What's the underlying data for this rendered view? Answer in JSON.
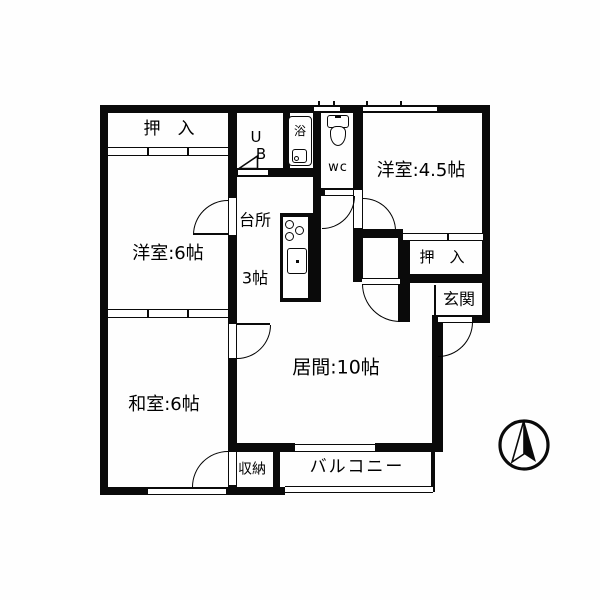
{
  "floorplan": {
    "labels": {
      "closet_top_left": "押　入",
      "western_room_6": "洋室:6帖",
      "japanese_room_6": "和室:6帖",
      "ub_line1": "U",
      "ub_line2": "B",
      "bath": "浴",
      "wc": "wc",
      "western_room_45": "洋室:4.5帖",
      "closet_right": "押　入",
      "entrance": "玄関",
      "kitchen_line1": "台所",
      "kitchen_line2": "3帖",
      "living_room": "居間:10帖",
      "storage": "収納",
      "balcony": "バルコニー"
    },
    "rooms": [
      {
        "name": "押入 (closet)",
        "location": "top-left"
      },
      {
        "name": "洋室",
        "size_tatami": "6帖",
        "location": "middle-left"
      },
      {
        "name": "和室",
        "size_tatami": "6帖",
        "location": "bottom-left"
      },
      {
        "name": "UB (unit bath)",
        "location": "top-center"
      },
      {
        "name": "浴 (bath)",
        "location": "top-center"
      },
      {
        "name": "wc (toilet)",
        "location": "top-center"
      },
      {
        "name": "台所",
        "size_tatami": "3帖",
        "location": "center"
      },
      {
        "name": "洋室",
        "size_tatami": "4.5帖",
        "location": "top-right"
      },
      {
        "name": "押入 (closet)",
        "location": "right"
      },
      {
        "name": "玄関 (entrance)",
        "location": "right"
      },
      {
        "name": "居間",
        "size_tatami": "10帖",
        "location": "center"
      },
      {
        "name": "収納 (storage)",
        "location": "bottom-center"
      },
      {
        "name": "バルコニー (balcony)",
        "location": "bottom"
      }
    ],
    "icons": [
      "compass-north-icon",
      "toilet-icon",
      "bathtub-icon",
      "stove-burners-icon",
      "kitchen-sink-icon",
      "ub-door-triangle-icon"
    ],
    "colors": {
      "wall": "#0a0a0a",
      "background": "#ffffff"
    }
  }
}
